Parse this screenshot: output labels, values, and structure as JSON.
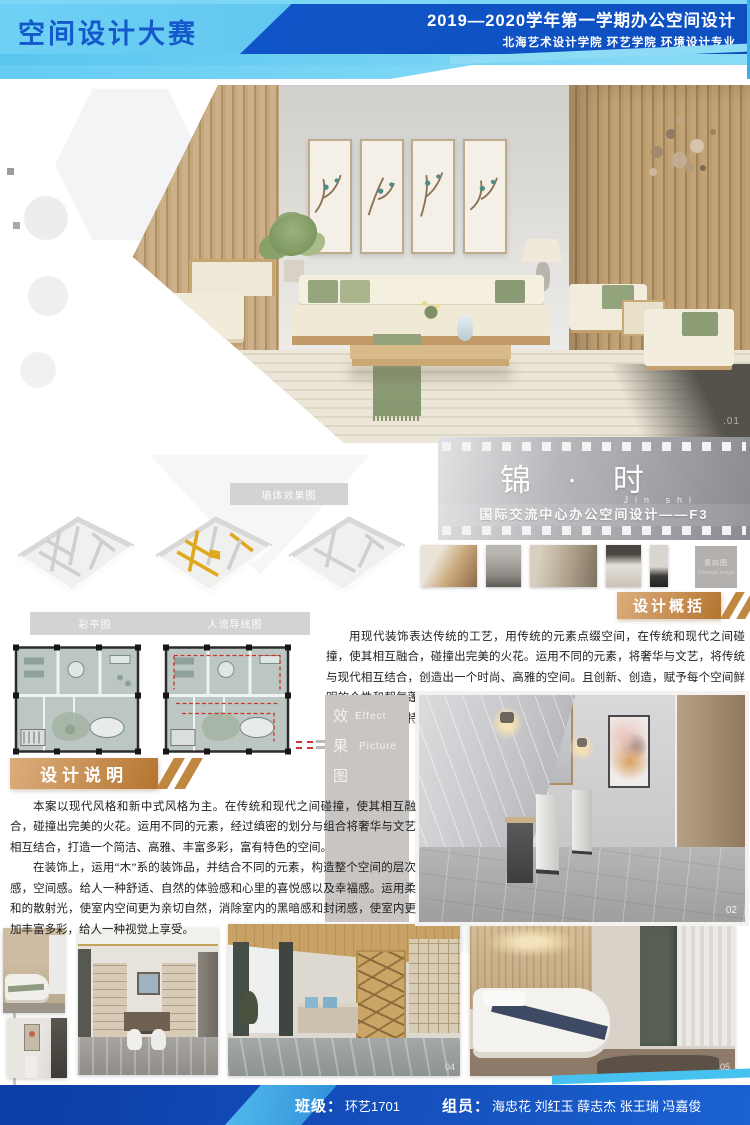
{
  "colors": {
    "header_light_blue": "#5ec9f1",
    "header_dark_blue": "#1157c9",
    "accent_copper": "#c08740",
    "filmstrip_gray": "#95969c",
    "axon_highlight_yellow": "#e0a81e",
    "circulation_red": "#d03328",
    "footer_blue": "#0d3da5"
  },
  "header": {
    "competition_title": "空间设计大赛",
    "course_title": "2019—2020学年第一学期办公空间设计",
    "department_line": "北海艺术设计学院 环艺学院 环境设计专业"
  },
  "hero": {
    "photo_number": ".01"
  },
  "project": {
    "title": "锦 · 时",
    "pinyin": "Jin  shi",
    "subtitle": "国际交流中心办公空间设计——F3"
  },
  "analysis": {
    "axon_bar_label": "墙体效果图",
    "plan_bar_label_left": "彩平图",
    "plan_bar_label_right": "人流导线图"
  },
  "concept": {
    "label_cn": "意向图",
    "label_en": "Concept Image"
  },
  "overview": {
    "heading": "设计概括",
    "body": "用现代装饰表达传统的工艺，用传统的元素点缀空间，在传统和现代之间碰撞，使其相互融合，碰撞出完美的火花。运用不同的元素，将奢华与文艺，将传统与现代相互结合，创造出一个时尚、高雅的空间。且创新、创造，赋予每个空间鲜明的个性和朝气蓬勃的生命力，提取与运用文化、艺术等方面的元素，结合当下，创造出一个富有特色、典雅及其时尚的空间。"
  },
  "description": {
    "heading": "设计说明",
    "para1": "本案以现代风格和新中式风格为主。在传统和现代之间碰撞，使其相互融合，碰撞出完美的火花。运用不同的元素，经过缜密的划分与组合将奢华与文艺相互结合，打造一个简洁、高雅、丰富多彩，富有特色的空间。",
    "para2": "在装饰上，运用“木”系的装饰品，并结合不同的元素，构造整个空间的层次感，空间感。给人一种舒适、自然的体验感和心里的喜悦感以及幸福感。运用柔和的散射光，使室内空间更为亲切自然，消除室内的黑暗感和封闭感，使室内更加丰富多彩，给人一种视觉上享受。"
  },
  "effect": {
    "label_cn_chars": [
      "效",
      "果",
      "图"
    ],
    "label_en_words": [
      "Effect",
      "Picture"
    ],
    "photo_number": "02"
  },
  "gallery": {
    "photo_number_office": "04",
    "photo_number_bedroom": "05"
  },
  "footer": {
    "class_label": "班级：",
    "class_value": "环艺1701",
    "team_label": "组员：",
    "team_value": "海忠花 刘红玉 薛志杰 张王瑞 冯嘉俊"
  }
}
